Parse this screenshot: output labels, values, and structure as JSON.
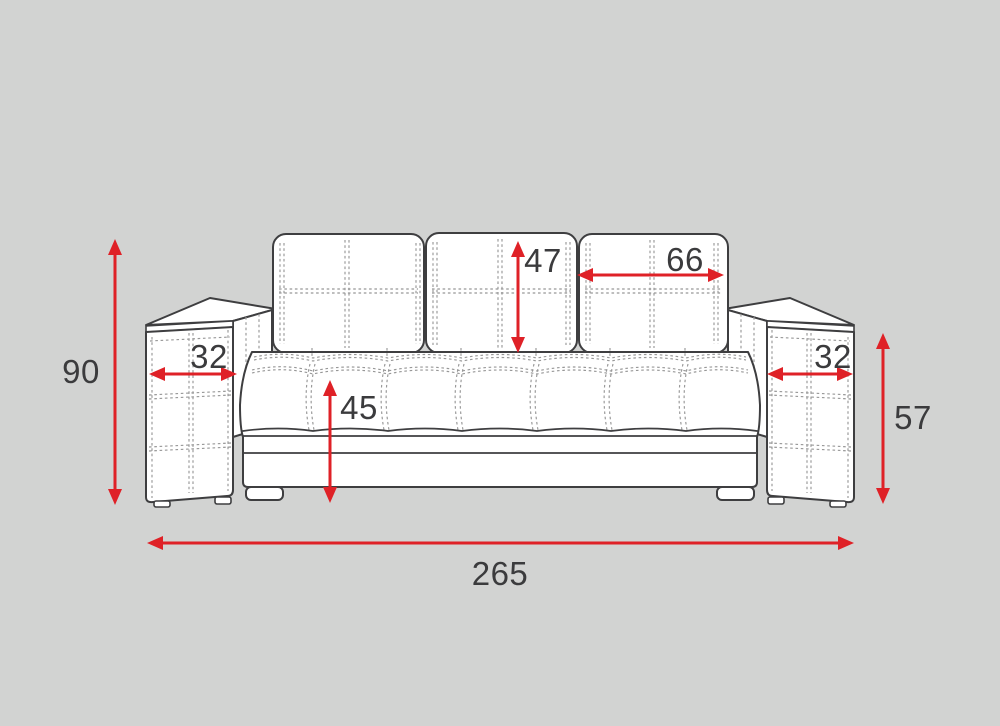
{
  "colors": {
    "background": "#d2d3d2",
    "line": "#3e3e40",
    "stitch": "#979797",
    "dimension_red": "#df2127",
    "label_text": "#3b3b3d"
  },
  "dimensions": {
    "overall_height": "90",
    "left_armrest_width": "32",
    "back_cushion_height": "47",
    "back_cushion_width": "66",
    "seat_height": "45",
    "right_armrest_width": "32",
    "armrest_height": "57",
    "overall_width": "265"
  }
}
